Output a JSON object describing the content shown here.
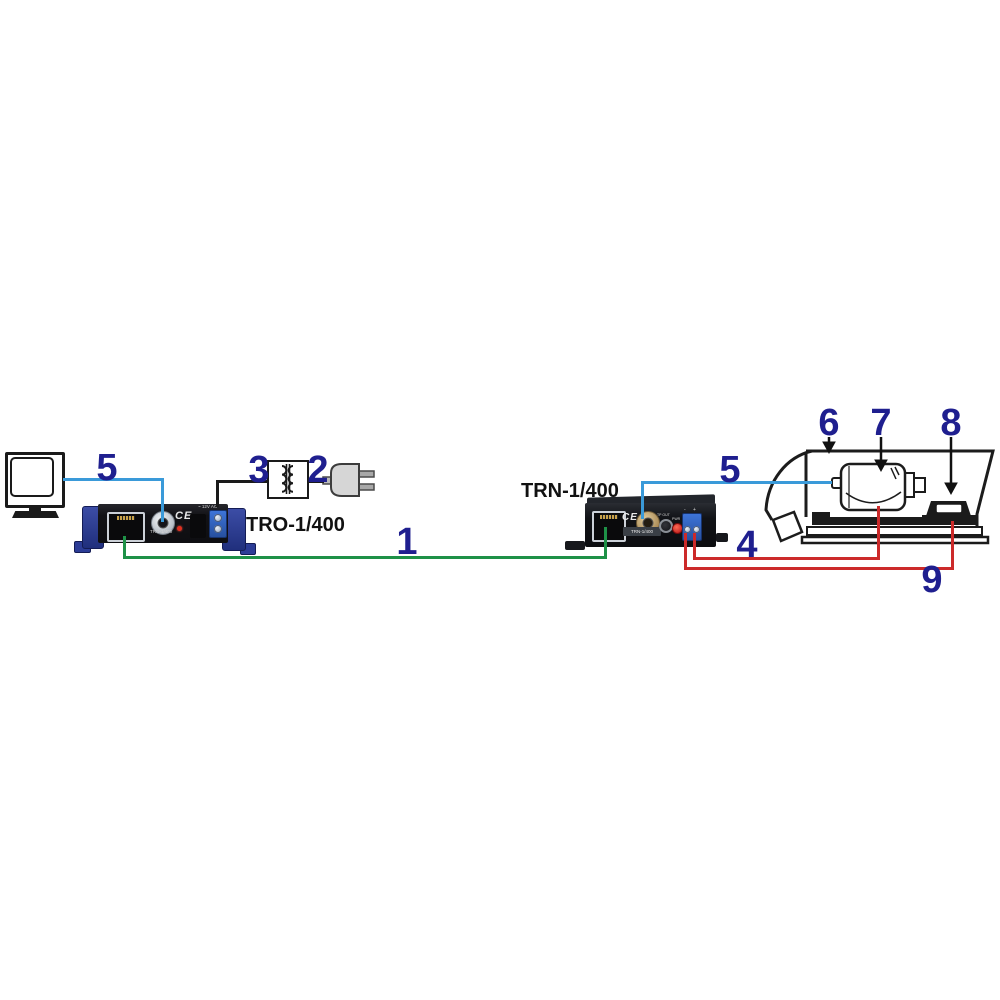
{
  "diagram": {
    "wire_labels": {
      "monitor_coax": "5",
      "power_supply": "3",
      "mains_plug": "2",
      "twisted_pair": "1",
      "camera_coax": "5",
      "housing": "6",
      "camera": "7",
      "heater": "8",
      "camera_power": "4",
      "heater_power": "9"
    },
    "device_left": {
      "title": "TRO-1/400",
      "panel": {
        "ce": "CE",
        "model": "TRO-1/400",
        "power": "~ 12V AC"
      }
    },
    "device_right": {
      "title": "TRN-1/400",
      "panel": {
        "ce": "CE",
        "model": "TRN-1/400",
        "tp_out": "TP OUT",
        "pwr": "PWR",
        "polarity": "- +"
      }
    },
    "colors": {
      "wire_video_blue": "#3a9ad9",
      "wire_twisted_pair_green": "#1e9147",
      "wire_power_red": "#cc2a2a",
      "wire_mains_black": "#1a1a1a",
      "number_label_navy": "#1f1f8f"
    }
  }
}
